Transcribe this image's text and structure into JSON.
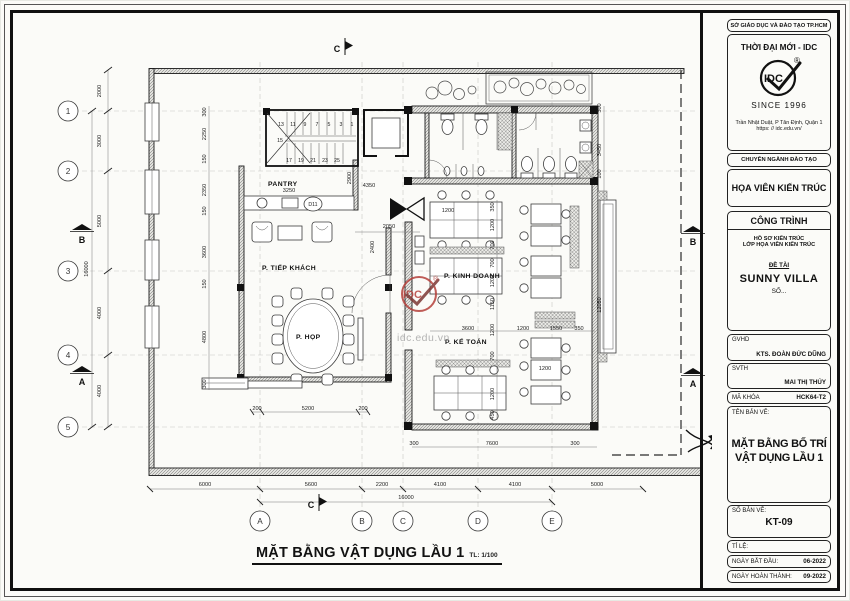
{
  "sheet": {
    "agency": "SỞ GIÁO DỤC VÀ ĐÀO TẠO TP.HCM",
    "brand": {
      "name": "THỜI ĐẠI MỚI - IDC",
      "logo_text": "IDC",
      "reg": "®",
      "since": "SINCE 1996",
      "address_line1": "Trần Nhật Duật, P Tân Định, Quận 1",
      "address_line2": "https: // idc.edu.vn/"
    },
    "training_label": "CHUYÊN NGÀNH ĐÀO TẠO",
    "major": "HỌA VIÊN KIẾN TRÚC",
    "project": {
      "header": "CÔNG TRÌNH",
      "line1": "HỒ SƠ KIẾN TRÚC",
      "line2": "LỚP HỌA VIÊN KIẾN TRÚC",
      "topic_label": "ĐỀ TÀI",
      "topic": "SUNNY VILLA",
      "number": "SỐ..."
    },
    "people": [
      {
        "label": "GVHD",
        "value": "KTS. ĐOÀN ĐỨC DŨNG"
      },
      {
        "label": "SVTH",
        "value": "MAI THỊ THÚY"
      },
      {
        "label": "MÃ KHÓA",
        "value": "HCK64-T2"
      }
    ],
    "drawing": {
      "name_label": "TÊN BẢN VẼ:",
      "name_line1": "MẶT BẰNG BỐ TRÍ",
      "name_line2": "VẬT DỤNG LẦU 1",
      "number_label": "SỐ BẢN VẼ:",
      "number": "KT-09",
      "scale_label": "TỈ LỆ:",
      "start_label": "NGÀY BẮT ĐẦU:",
      "start": "06-2022",
      "finish_label": "NGÀY HOÀN THÀNH:",
      "finish": "09-2022"
    }
  },
  "plan": {
    "title": "MẶT BẰNG VẬT DỤNG LẦU 1",
    "scale": "TL: 1/100",
    "rooms": {
      "pantry": "PANTRY",
      "reception": "P. TIẾP KHÁCH",
      "meeting": "P. HỌP",
      "business": "P. KINH DOANH",
      "accounting": "P. KẾ TOÁN"
    },
    "door_tag": "D11",
    "grid_rows": [
      "1",
      "2",
      "3",
      "4",
      "5"
    ],
    "grid_cols": [
      "A",
      "B",
      "C",
      "D",
      "E"
    ],
    "markers": {
      "a": "A",
      "b": "B",
      "c": "C"
    },
    "dims_left": [
      "2000",
      "3000",
      "5000",
      "4000",
      "4000"
    ],
    "dims_left_total": "16000",
    "dims_bottom": [
      "6000",
      "5600",
      "2200",
      "4100",
      "4100",
      "5000"
    ],
    "dims_bottom_total": "16000",
    "stairs": {
      "top": [
        "13",
        "11",
        "9",
        "7",
        "5",
        "3",
        "1"
      ],
      "mid": "15",
      "bottom": [
        "17",
        "19",
        "21",
        "23",
        "25"
      ]
    },
    "d": [
      "3250",
      "2900",
      "4350",
      "2050",
      "2400",
      "1200",
      "350",
      "1200",
      "700",
      "700",
      "1200",
      "1150",
      "1200",
      "700",
      "1200",
      "450",
      "3600",
      "1200",
      "1550",
      "350",
      "300",
      "3450",
      "100",
      "12050",
      "5200",
      "200",
      "200",
      "300",
      "7600",
      "300",
      "300",
      "2250",
      "150",
      "2350",
      "150",
      "3600",
      "150",
      "4800",
      "300",
      "1200"
    ],
    "watermark": {
      "logo": "IDC",
      "reg": "®",
      "url": "idc.edu.vn",
      "color": "#b5413c"
    }
  }
}
